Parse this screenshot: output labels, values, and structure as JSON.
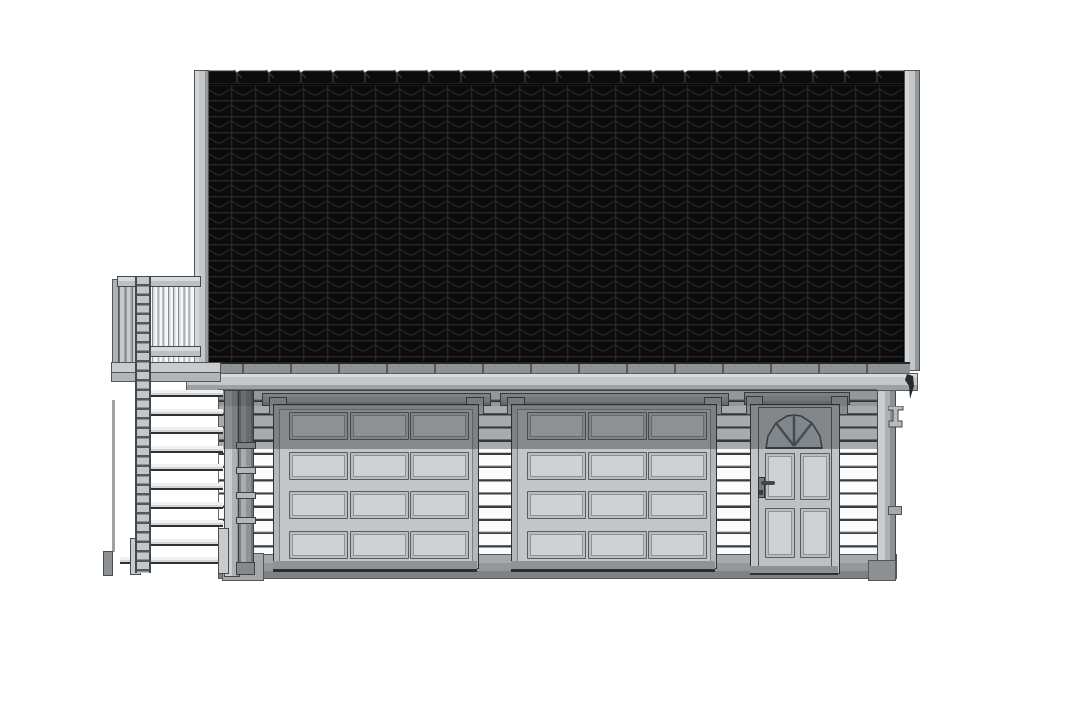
{
  "scene": {
    "title": "Garage front elevation drawing",
    "drawing_type": "architectural elevation (CAD style)",
    "view": "front elevation",
    "background_color": "#ffffff"
  },
  "palette": {
    "roof_black": "#0b0b0b",
    "roof_pattern_line": "#272727",
    "trim_light": "#c6c9cb",
    "trim_mid": "#b4b8ba",
    "outline_dark": "#46494c",
    "siding_white": "#fcfcfc",
    "siding_line": "#3a3d3f",
    "shadow": "rgba(44,48,50,0.40)",
    "foundation_gray": "#93979a",
    "glass_gray_blue": "#b6c2c8"
  },
  "roof": {
    "ridge_cap_count": 22,
    "tile_cell_w": 24,
    "tile_cell_h": 16,
    "has_left_barge_board": true,
    "has_right_barge_board": true
  },
  "eave": {
    "has_gutter": true,
    "gutter_bracket_spacing_px": 48,
    "has_right_drip_outlet": true
  },
  "garage_doors": {
    "count": 2,
    "panel_rows": 4,
    "panel_cols": 3,
    "x_positions": [
      262,
      500
    ],
    "top_row_in_shadow": true
  },
  "entry_door": {
    "panel_rows": 2,
    "panel_cols": 2,
    "fanlight_panes": 4,
    "has_lever_handle": true,
    "has_lock_cylinder": true
  },
  "stair": {
    "tread_count": 10,
    "has_ladder_rail": true,
    "foot_posts": 3
  },
  "balcony": {
    "has_railing": true,
    "baluster_section": true,
    "side_slat_section": true
  },
  "downspout": {
    "collar_ys": [
      442,
      467,
      492,
      517
    ],
    "has_shoe": true
  },
  "right_side": {
    "has_corbel_bracket": true,
    "has_wall_tie": true
  }
}
